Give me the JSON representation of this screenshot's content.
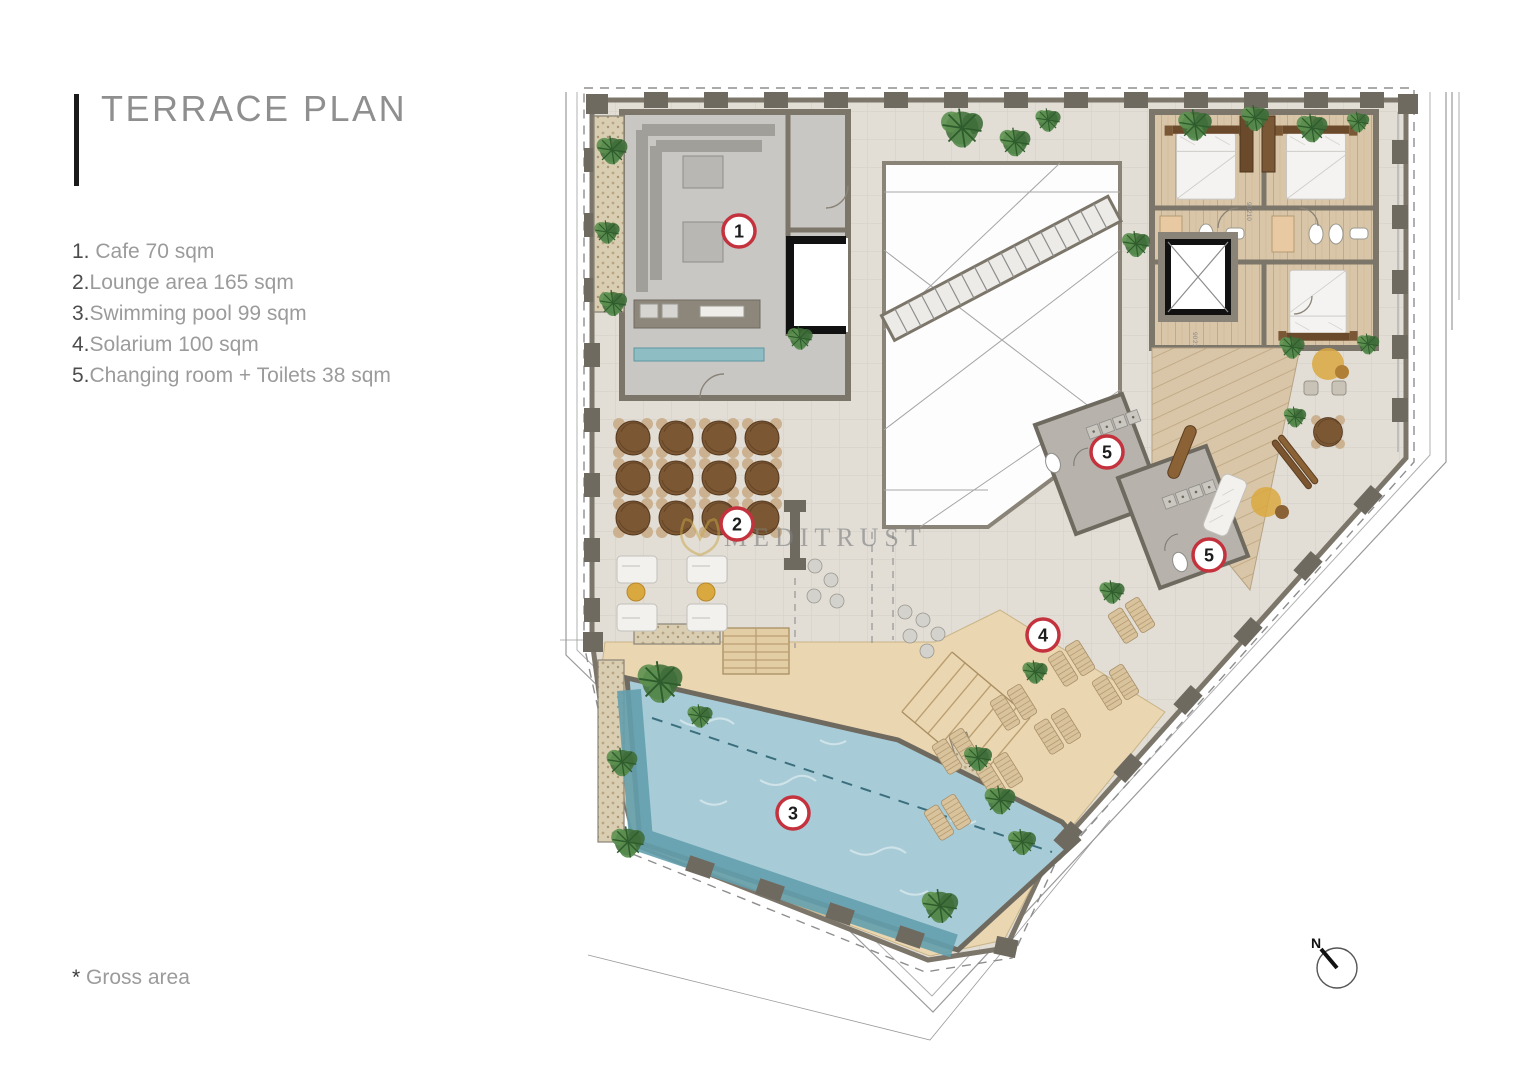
{
  "page": {
    "title": "TERRACE PLAN"
  },
  "legend": {
    "items": [
      {
        "number": "1.",
        "sep": " ",
        "text": "Cafe 70 sqm"
      },
      {
        "number": "2.",
        "sep": "",
        "text": "Lounge area 165 sqm"
      },
      {
        "number": "3.",
        "sep": "",
        "text": "Swimming pool 99 sqm"
      },
      {
        "number": "4.",
        "sep": "",
        "text": "Solarium 100 sqm"
      },
      {
        "number": "5.",
        "sep": "",
        "text": "Changing room + Toilets 38 sqm"
      }
    ]
  },
  "footnote": {
    "star": "*",
    "text": " Gross area"
  },
  "watermark": {
    "text": "MEDITRUST"
  },
  "north": {
    "label": "N"
  },
  "door_dimension": {
    "width": "90",
    "height": "210"
  },
  "markers": [
    {
      "label": "1",
      "x": 739,
      "y": 231
    },
    {
      "label": "2",
      "x": 737,
      "y": 524
    },
    {
      "label": "3",
      "x": 793,
      "y": 813
    },
    {
      "label": "4",
      "x": 1043,
      "y": 635
    },
    {
      "label": "5",
      "x": 1107,
      "y": 452
    },
    {
      "label": "5",
      "x": 1209,
      "y": 555
    }
  ],
  "colors": {
    "accent_red": "#c4323e",
    "gold": "#c9a646",
    "pool_water": "#a8ccd7",
    "pool_deep": "#63a0ae",
    "sand_deck": "#ead6b0",
    "wall_gray": "#7c766a",
    "wood_floor": "#d9c6a8",
    "plant_green": "#417038",
    "terrace_tile": "#e2ded6"
  }
}
